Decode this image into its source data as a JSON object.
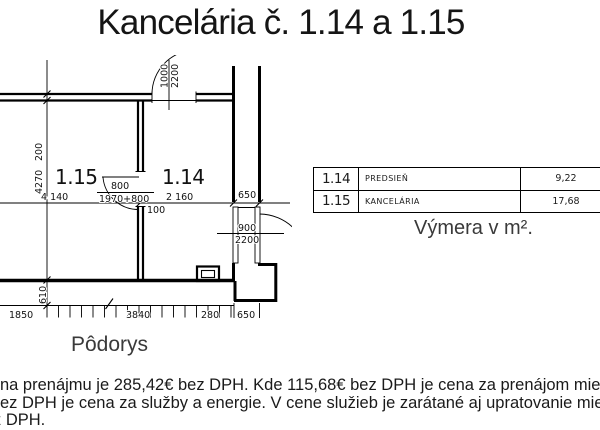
{
  "title": "Kancelária č. 1.14 a 1.15",
  "plan": {
    "caption": "Pôdorys",
    "rooms": [
      {
        "id": "1.15"
      },
      {
        "id": "1.14"
      }
    ],
    "dims": {
      "wall_top": "200",
      "height_left": "4270",
      "width_room115": "4 140",
      "door115_width": "800",
      "door115_chain": "1970+800",
      "width_room114": "2 160",
      "corridor_width": "650",
      "wall_mid": "100",
      "door_top_width": "1000",
      "door_top_height": "2200",
      "door_right_width": "900",
      "door_right_height": "2200",
      "step_band": "610",
      "bottom_seg1": "1850",
      "bottom_seg2": "3840",
      "bottom_seg3": "280",
      "bottom_seg4": "650"
    }
  },
  "table": {
    "rows": [
      {
        "number": "1.14",
        "name": "PREDSIEŇ",
        "area": "9,22"
      },
      {
        "number": "1.15",
        "name": "KANCELÁRIA",
        "area": "17,68"
      }
    ],
    "caption": "Výmera v m²."
  },
  "footer": {
    "lines": [
      "na prenájmu je 285,42€ bez DPH. Kde 115,68€ bez DPH je cena za prenájom miestnosti",
      "ez DPH je cena za služby a energie. V cene služieb je zarátané aj upratovanie miestností",
      "z DPH."
    ]
  }
}
